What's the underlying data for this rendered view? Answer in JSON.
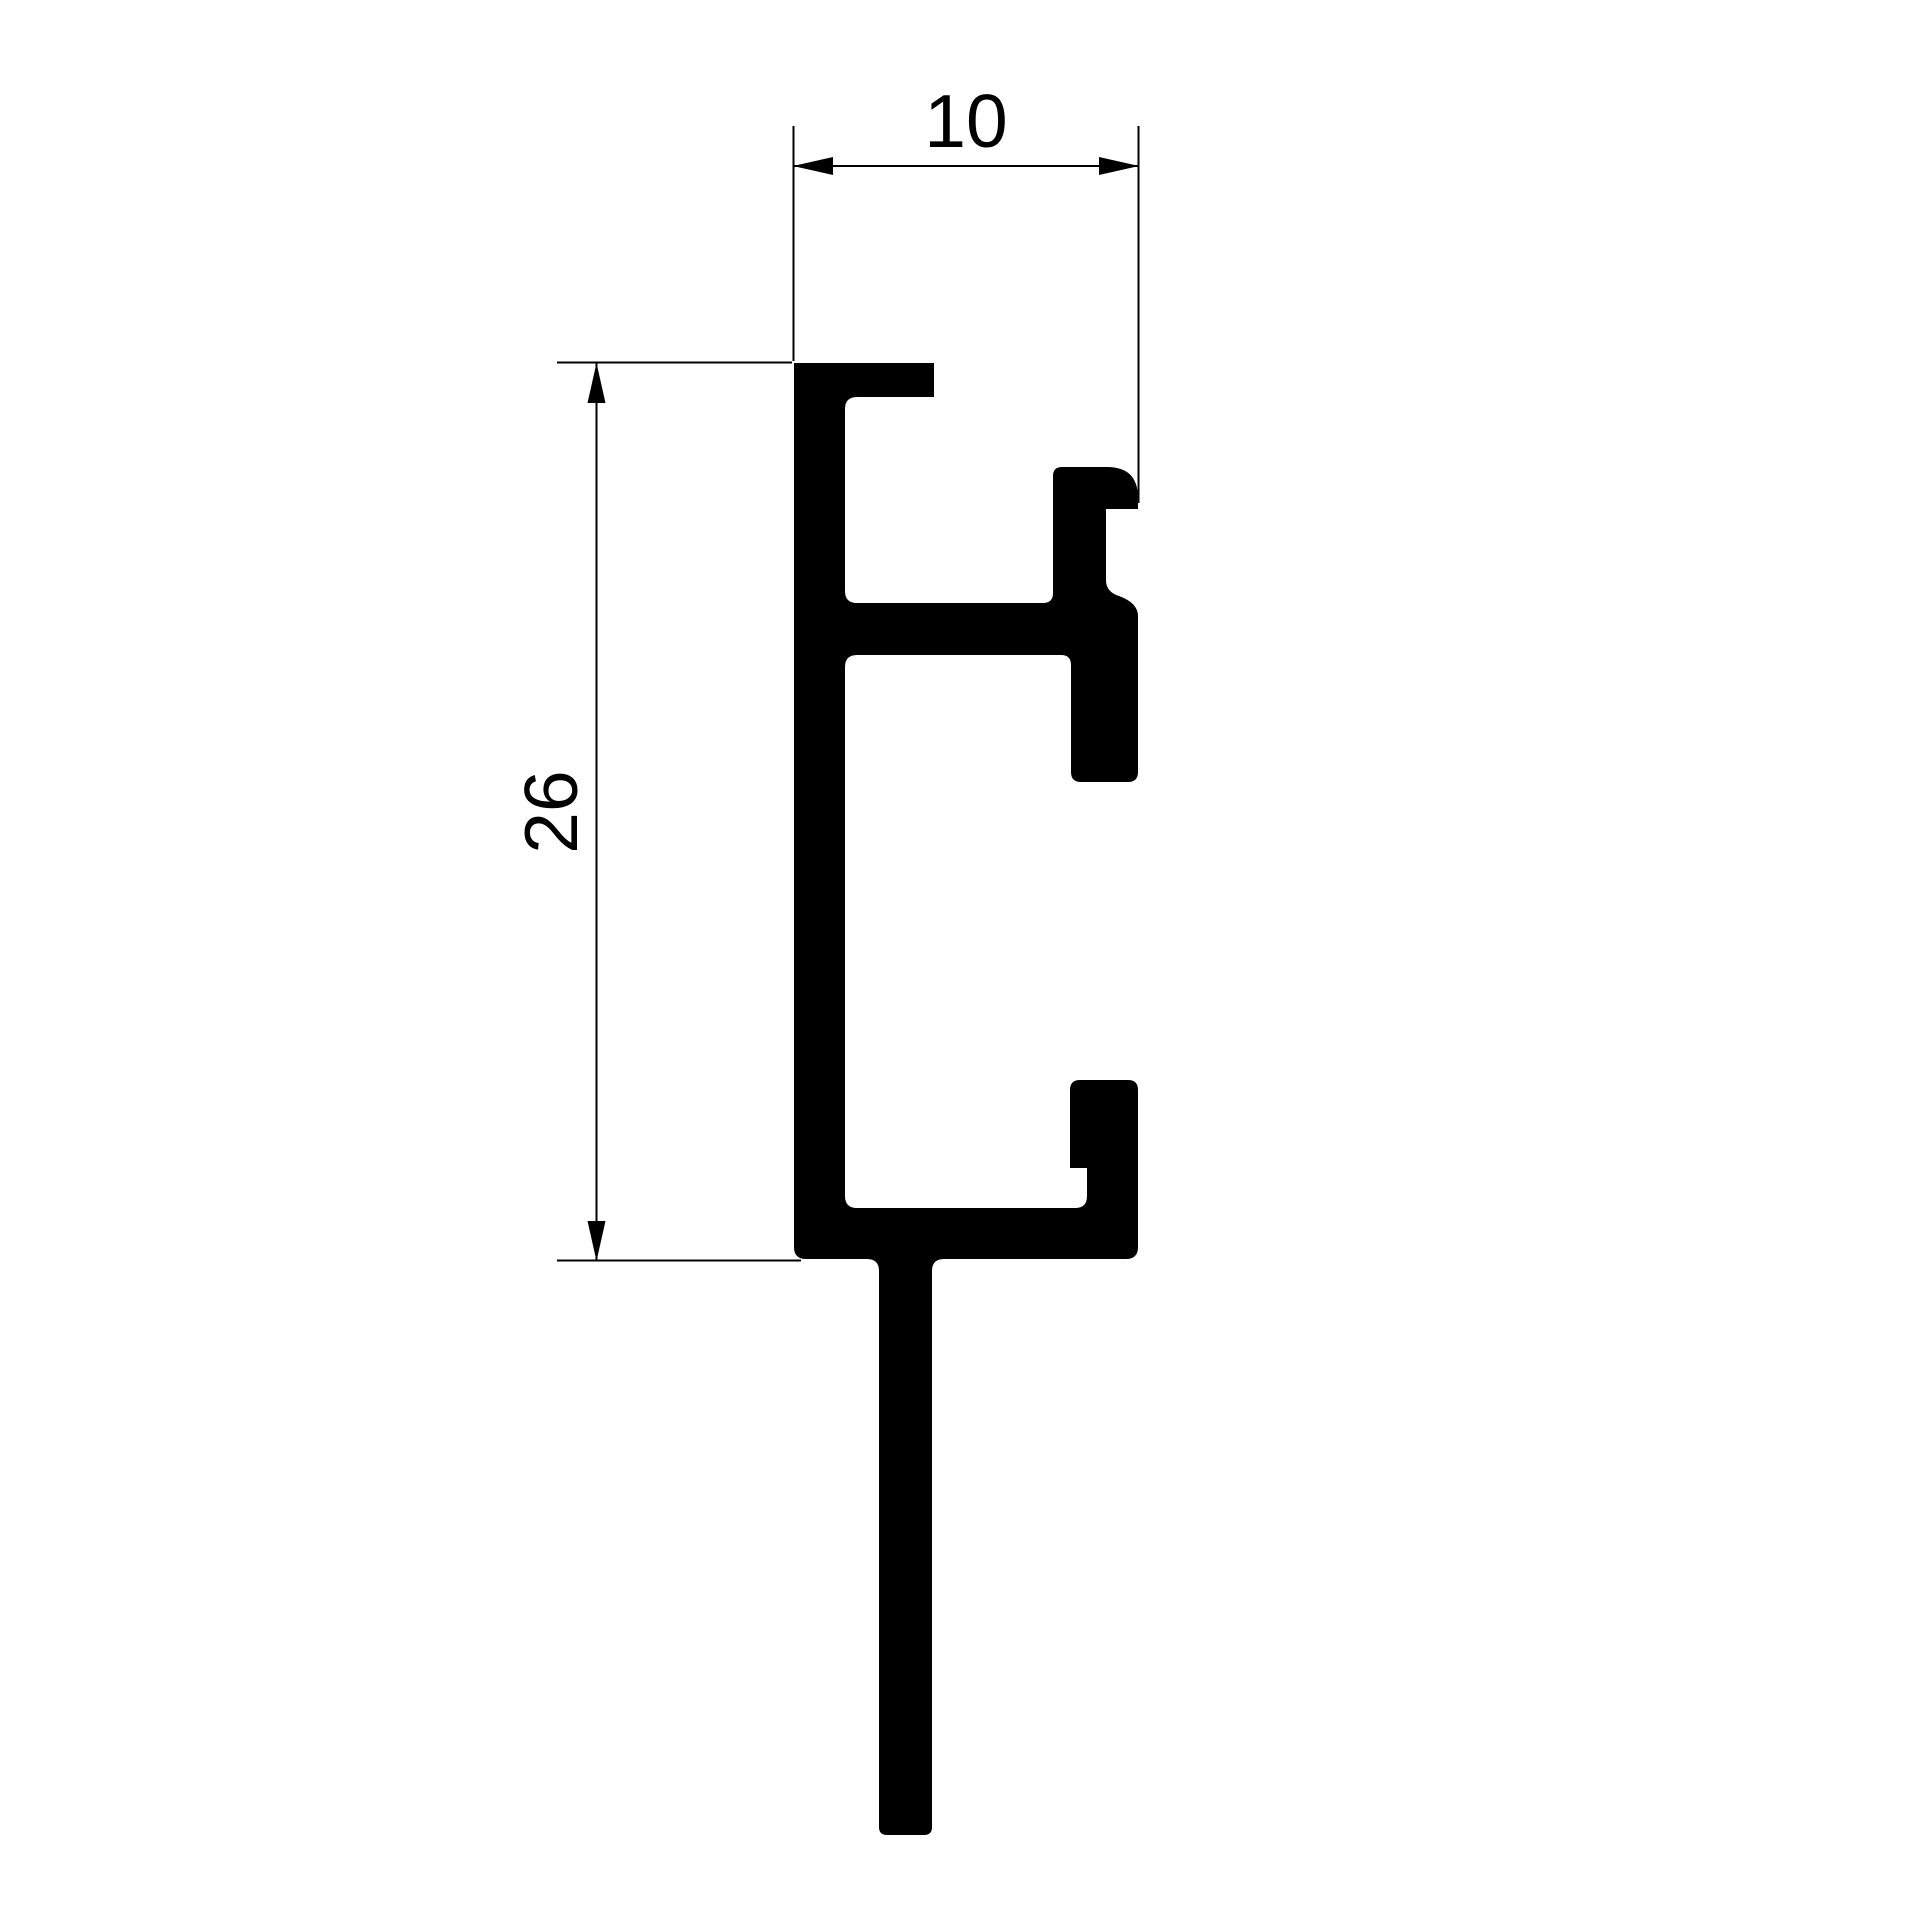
{
  "canvas": {
    "width": 1920,
    "height": 1920,
    "background": "#ffffff"
  },
  "drawing": {
    "type": "technical-cross-section-drawing",
    "ink_color": "#000000",
    "line_color": "#000000",
    "line_width": 2,
    "font_size": 75,
    "profile": {
      "name": "extrusion-profile-cross-section",
      "path": "M794,363 H934 V397 H857 Q845,397 845,409 V591 Q845,603 857,603 H1043 Q1053,603 1053,593 V476 Q1053,467 1062,467 H1107 Q1138,467 1138,498 V509 H1106 V580 Q1106,592 1119,596 Q1138,603 1138,616 V772 Q1138,782 1128,782 H1081 Q1071,782 1071,772 V665 Q1071,655 1061,655 H857 Q845,655 845,667 V1196 Q845,1208 857,1208 H1075 Q1087,1208 1087,1196 V1168 H1070 V1090 Q1070,1080 1080,1080 H1128 Q1138,1080 1138,1090 V1247 Q1138,1259 1126,1259 H944 Q932,1259 932,1271 V1827 Q932,1835 924,1835 H887 Q879,1835 879,1827 V1271 Q879,1259 867,1259 H806 Q794,1259 794,1247 Z"
    },
    "dimensions": {
      "width": {
        "label": "10",
        "label_x": "966",
        "label_y": "147",
        "line_path": "M793.5,166 H1138.5",
        "ext_line_a": "M793.5,126 V361",
        "ext_line_b": "M1138.5,126 V503",
        "arrow_a_points": "793,166 833,157 833,175",
        "arrow_b_points": "1139,166 1099,157 1099,175"
      },
      "height": {
        "label": "26",
        "label_x": "577",
        "label_y": "812",
        "label_transform": "rotate(-90 577 812)",
        "line_path": "M596.5,363 V1261",
        "ext_line_a": "M557,362.5 H792",
        "ext_line_b": "M557,1260.5 H801",
        "arrow_a_points": "596.5,363 587.5,403 605.5,403",
        "arrow_b_points": "596.5,1261 587.5,1221 605.5,1221"
      }
    }
  }
}
